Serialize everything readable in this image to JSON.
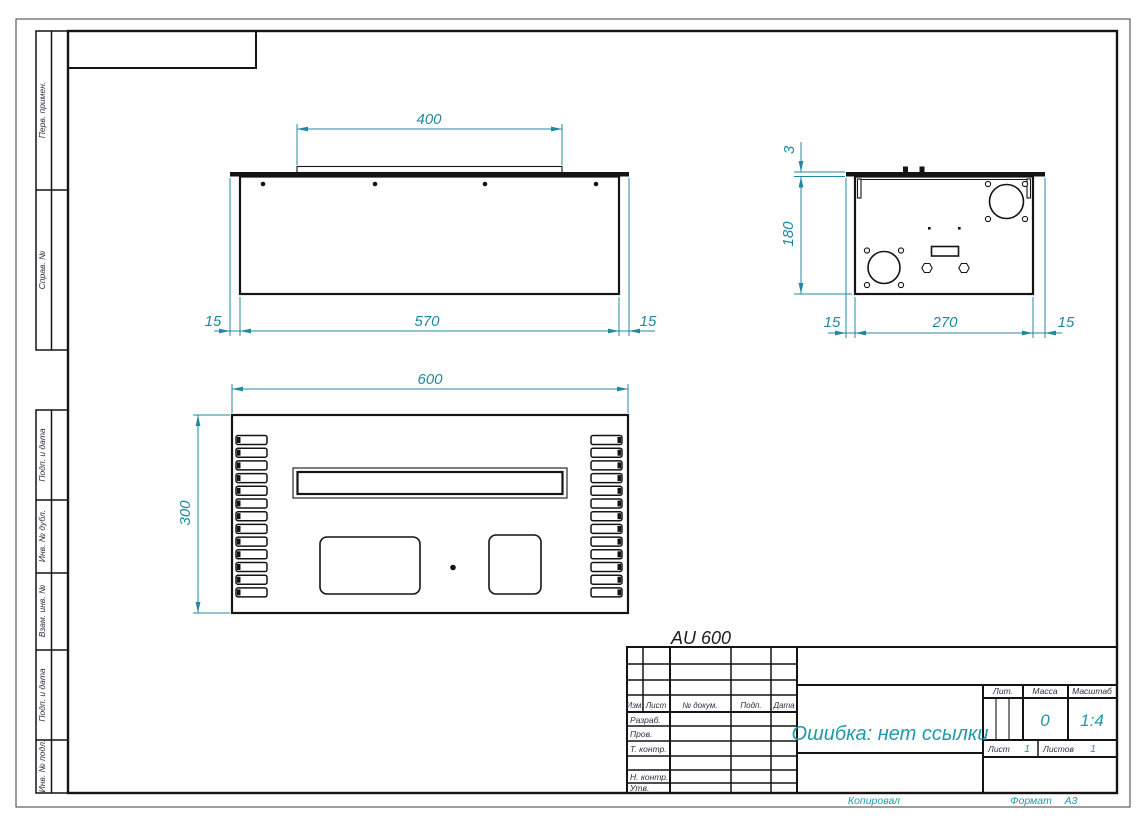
{
  "sheet": {
    "model_label": "AU 600",
    "accent_color": "#2089a0",
    "line_color": "#141414"
  },
  "margin_labels": {
    "perv_primen": "Перв. примен.",
    "sprav_no": "Справ. №",
    "podp_i_data_top": "Подп. и дата",
    "inv_no_dubl": "Инв. № дубл.",
    "vzam_inv_no": "Взам. инв. №",
    "podp_i_data_bottom": "Подп. и дата",
    "inv_no_podl": "Инв. № подл."
  },
  "views": {
    "front": {
      "dim_top": "400",
      "dim_left": "15",
      "dim_mid": "570",
      "dim_right": "15"
    },
    "side": {
      "dim_flange": "3",
      "dim_height": "180",
      "dim_left": "15",
      "dim_mid": "270",
      "dim_right": "15"
    },
    "bottom": {
      "dim_width": "600",
      "dim_height": "300",
      "vent_slots_per_side": 13
    }
  },
  "title_block": {
    "columns": {
      "izm": "Изм.",
      "list": "Лист",
      "no_dokum": "№ докум.",
      "podp": "Подп.",
      "data": "Дата"
    },
    "rows": {
      "razrab": "Разраб.",
      "prov": "Пров.",
      "t_kontr": "Т. контр.",
      "n_kontr": "Н. контр.",
      "utv": "Утв."
    },
    "title": "Ошибка: нет ссылки",
    "lit_label": "Лит.",
    "massa_label": "Масса",
    "masshtab_label": "Масштаб",
    "massa_value": "0",
    "masshtab_value": "1:4",
    "list_label": "Лист",
    "list_value": "1",
    "listov_label": "Листов",
    "listov_value": "1",
    "kopiroval": "Копировал",
    "format_label": "Формат",
    "format_value": "А3"
  }
}
